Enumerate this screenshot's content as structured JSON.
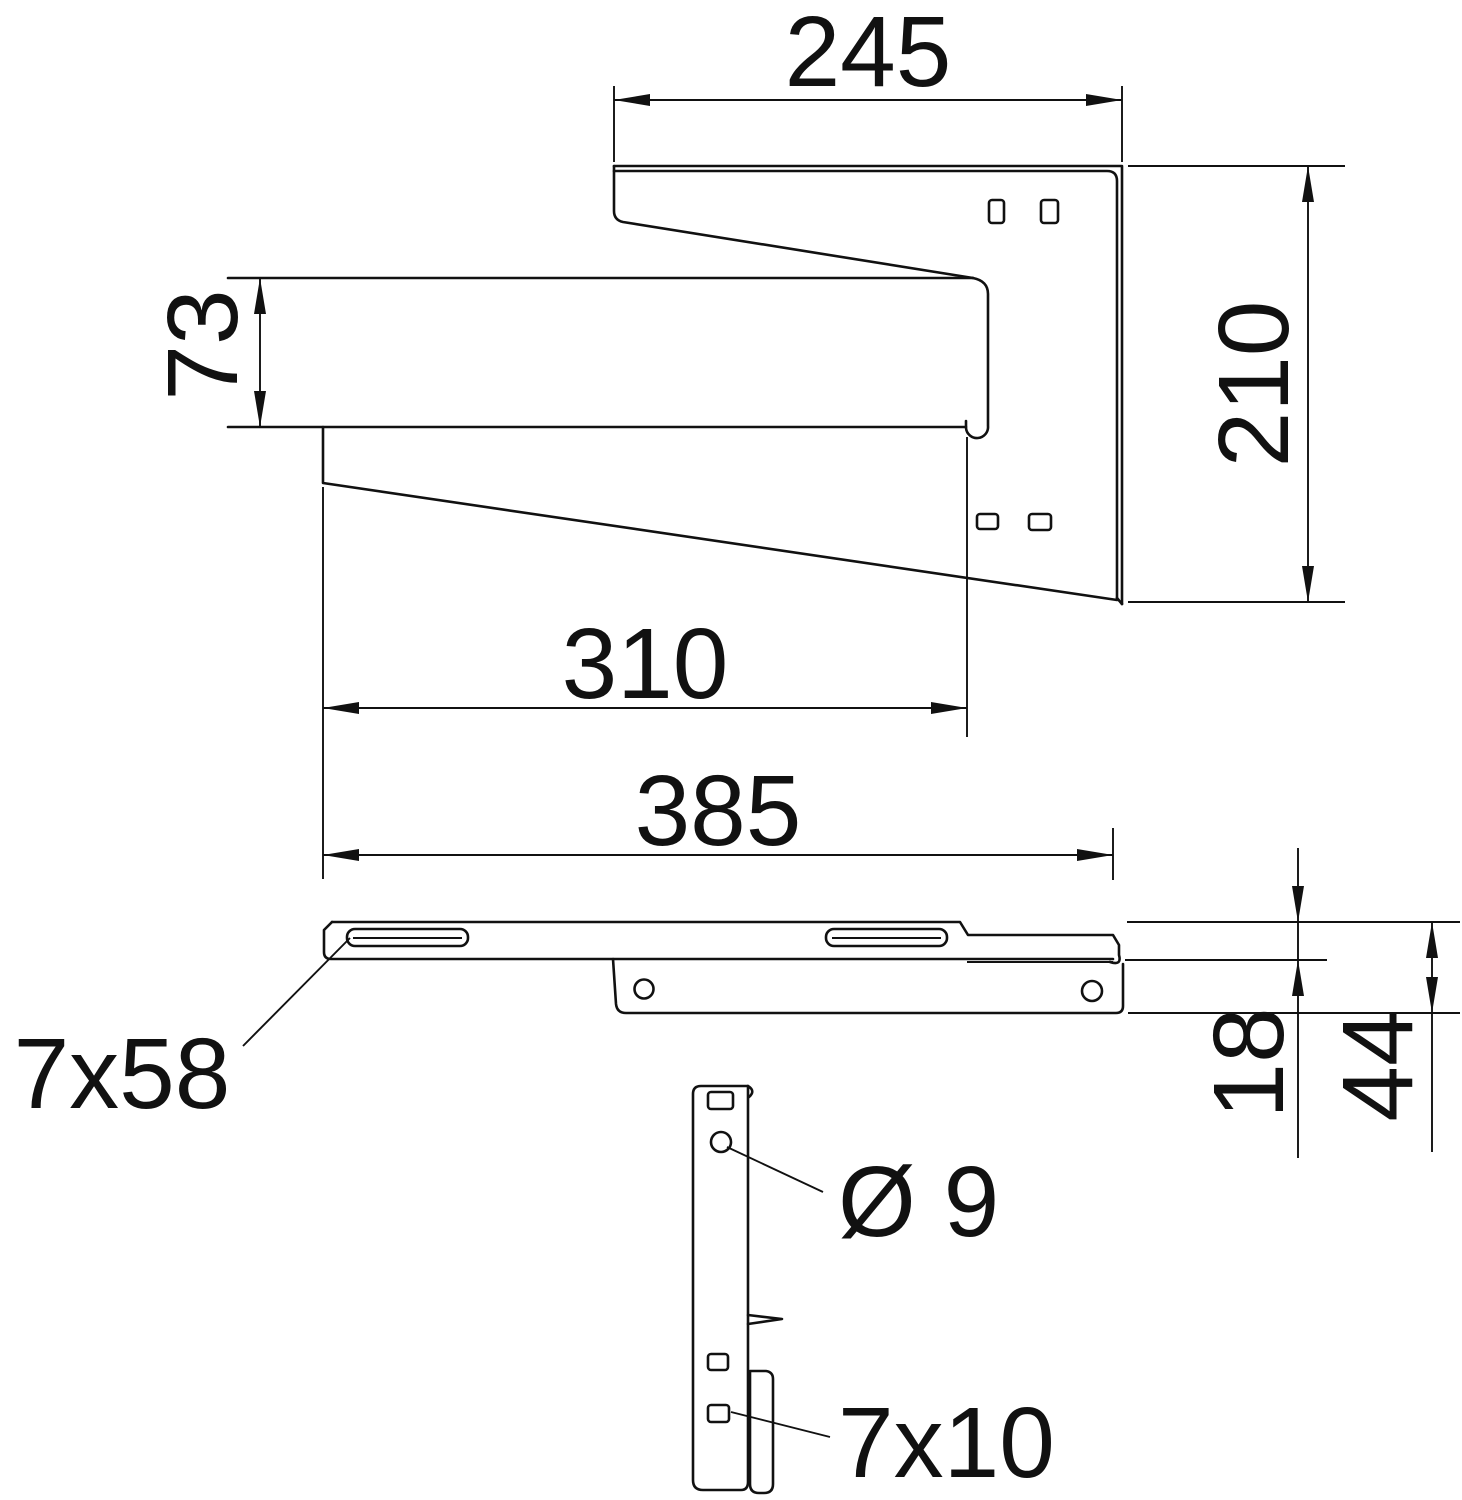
{
  "drawing": {
    "type": "technical-dimension-drawing",
    "subject": "wall-and-support bracket, three orthographic views",
    "colors": {
      "background": "#ffffff",
      "line": "#111111"
    }
  },
  "dims": {
    "top_flange_width": "245",
    "plate_height": "210",
    "jaw_opening": "73",
    "inner_length": "310",
    "overall_length": "385",
    "long_slot": "7x58",
    "rail_height": "18",
    "overall_height": "44",
    "hole_diameter": "Ø 9",
    "small_slot": "7x10"
  }
}
